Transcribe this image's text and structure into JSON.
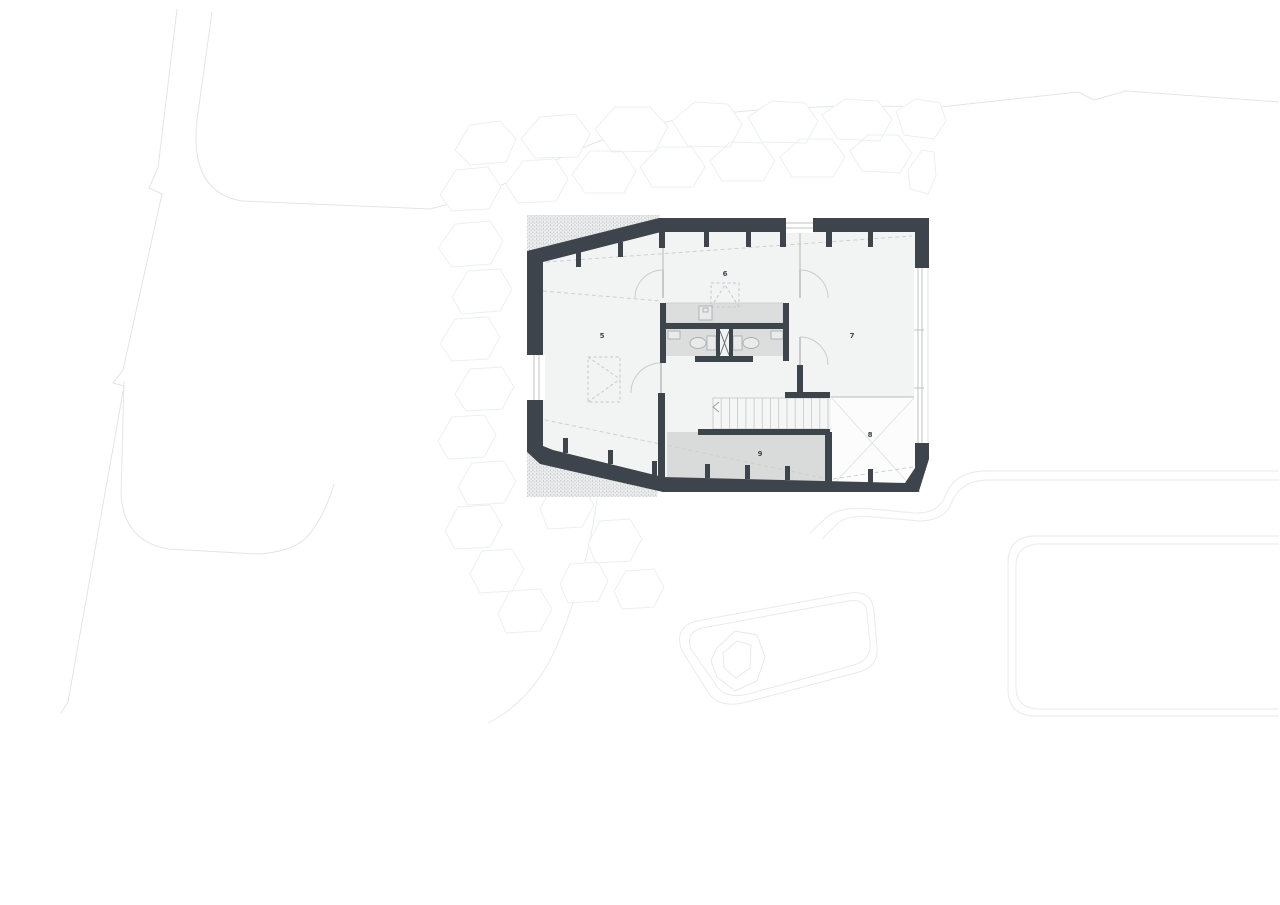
{
  "plan": {
    "room_labels": [
      {
        "label": "5"
      },
      {
        "label": "6"
      },
      {
        "label": "7"
      },
      {
        "label": "8"
      },
      {
        "label": "9"
      }
    ],
    "colors": {
      "wall": "#3d444b",
      "floor": "#f2f3f3",
      "service_gray": "#dcdede",
      "room9_gray": "#d9dbdb",
      "room8_white": "#fcfcfd",
      "thin_line": "#c9cccc",
      "site_line": "#e7e9e9",
      "background": "#ffffff"
    }
  }
}
